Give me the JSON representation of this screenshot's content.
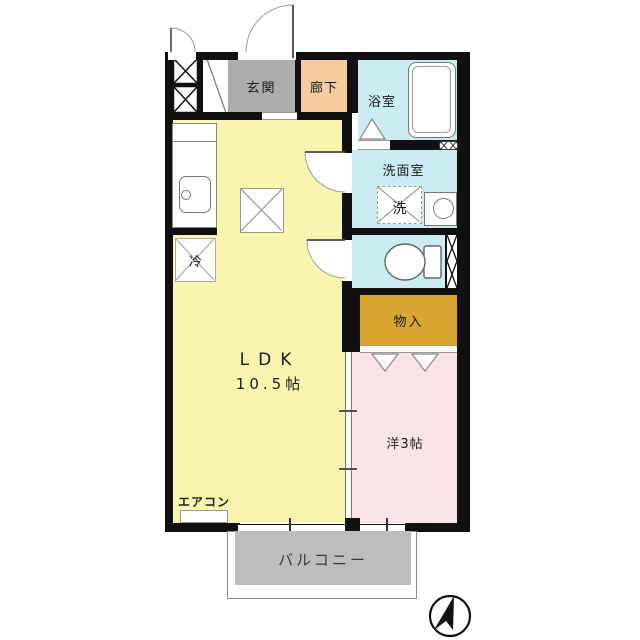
{
  "rooms": {
    "genkan": "玄関",
    "hallway": "廊下",
    "bathroom": "浴室",
    "washroom": "洗面室",
    "washer": "洗",
    "storage": "物入",
    "ldk_label": "LDK",
    "ldk_size": "10.5帖",
    "western_room": "洋3帖",
    "balcony": "バルコニー"
  },
  "fixtures": {
    "aircon": "エアコン",
    "fridge": "冷"
  },
  "icons": {
    "compass": "north-arrow-compass",
    "meter_box": "crossed-box-shaft",
    "pipe_shaft": "hatched-pipe-space",
    "window": "wall-window"
  },
  "colors": {
    "ldk": "#F8F5AF",
    "genkan": "#ADADAD",
    "hallway": "#F4CCA0",
    "wet_rooms": "#CBEDF2",
    "storage": "#D9A62F",
    "western_room": "#F9E3E5",
    "balcony_fill": "#BDBDBD",
    "wall": "#111111"
  }
}
